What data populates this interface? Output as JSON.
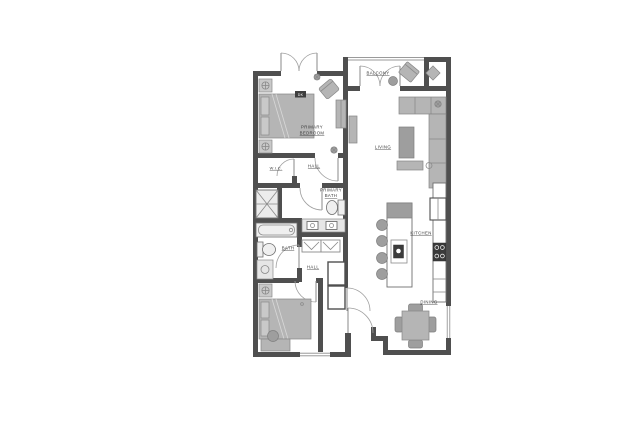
{
  "rooms": {
    "balcony": "BALCONY",
    "primary_bedroom": {
      "line1": "PRIMARY",
      "line2": "BEDROOM"
    },
    "living": "LIVING",
    "kitchen": "KITCHEN",
    "dining": "DINING",
    "hall_upper": "HALL",
    "hall_lower": "HALL",
    "wic": "W.I.C.",
    "primary_bath": {
      "line1": "PRIMARY",
      "line2": "BATH"
    },
    "bath": "BATH"
  },
  "annotations": {
    "bed_tag": "DK"
  },
  "colors": {
    "background": "#ffffff",
    "wall": "#4f4f4f",
    "furniture": "#b5b5b5",
    "furniture_dark": "#9e9e9e",
    "line": "#8a8a8a",
    "appliance": "#3b3b3b",
    "label": "#3a3a3a"
  }
}
